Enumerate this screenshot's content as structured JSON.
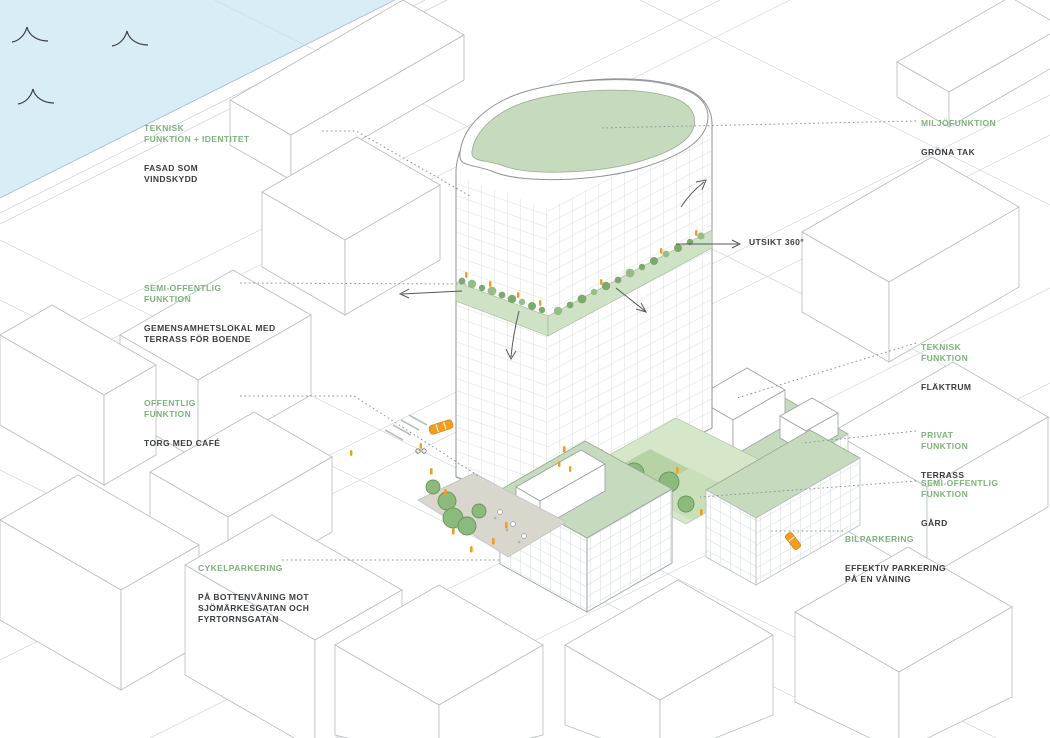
{
  "diagram_type": "axonometric architectural concept diagram",
  "colors": {
    "label_green": "#7cb47a",
    "text_dark": "#3a3d3f",
    "water_blue": "#d9edf6",
    "roof_green": "#c6dabd",
    "courtyard_green": "#b7d3a6",
    "tree_green": "#8cba7d",
    "accent_orange": "#f59c1e",
    "line_gray": "#b6bcc0",
    "leader_gray": "#8d9296"
  },
  "annotations": [
    {
      "id": "facade",
      "heading": "TEKNISK\nFUNKTION + IDENTITET",
      "body": "FASAD SOM\nVINDSKYDD"
    },
    {
      "id": "community",
      "heading": "SEMI-OFFENTLIG\nFUNKTION",
      "body": "GEMENSAMHETSLOKAL MED\nTERRASS FÖR BOENDE"
    },
    {
      "id": "public",
      "heading": "OFFENTLIG\nFUNKTION",
      "body": "TORG MED CAFÉ"
    },
    {
      "id": "bike-parking",
      "heading": "CYKELPARKERING",
      "body": "PÅ BOTTENVÅNING MOT\nSJÖMÄRKESGATAN OCH\nFYRTORNSGATAN"
    },
    {
      "id": "environment",
      "heading": "MILJÖFUNKTION",
      "body": "GRÖNA TAK"
    },
    {
      "id": "technical",
      "heading": "TEKNISK\nFUNKTION",
      "body": "FLÄKTRUM"
    },
    {
      "id": "private",
      "heading": "PRIVAT\nFUNKTION",
      "body": "TERRASS"
    },
    {
      "id": "semi-public-yard",
      "heading": "SEMI-OFFENTLIG\nFUNKTION",
      "body": "GÅRD"
    },
    {
      "id": "car-parking",
      "heading": "BILPARKERING",
      "body": "EFFEKTIV PARKERING\nPÅ EN VÅNING"
    }
  ],
  "callouts": {
    "view": "UTSIKT 360°"
  },
  "scene": {
    "water": "harbor water with wave symbols, top-left",
    "tower": "rounded high-rise with green roof and mid-level planted terrace band",
    "podium": "lower blocks with green roofs, rooftop vent room, courtyard with trees",
    "plaza": "ground-level square with café, trees and people",
    "accents": "orange people and cars",
    "icon_names": [
      "wave-icon",
      "tree-icon",
      "car-icon",
      "person-icon",
      "arrow-icon",
      "leader-line"
    ]
  }
}
